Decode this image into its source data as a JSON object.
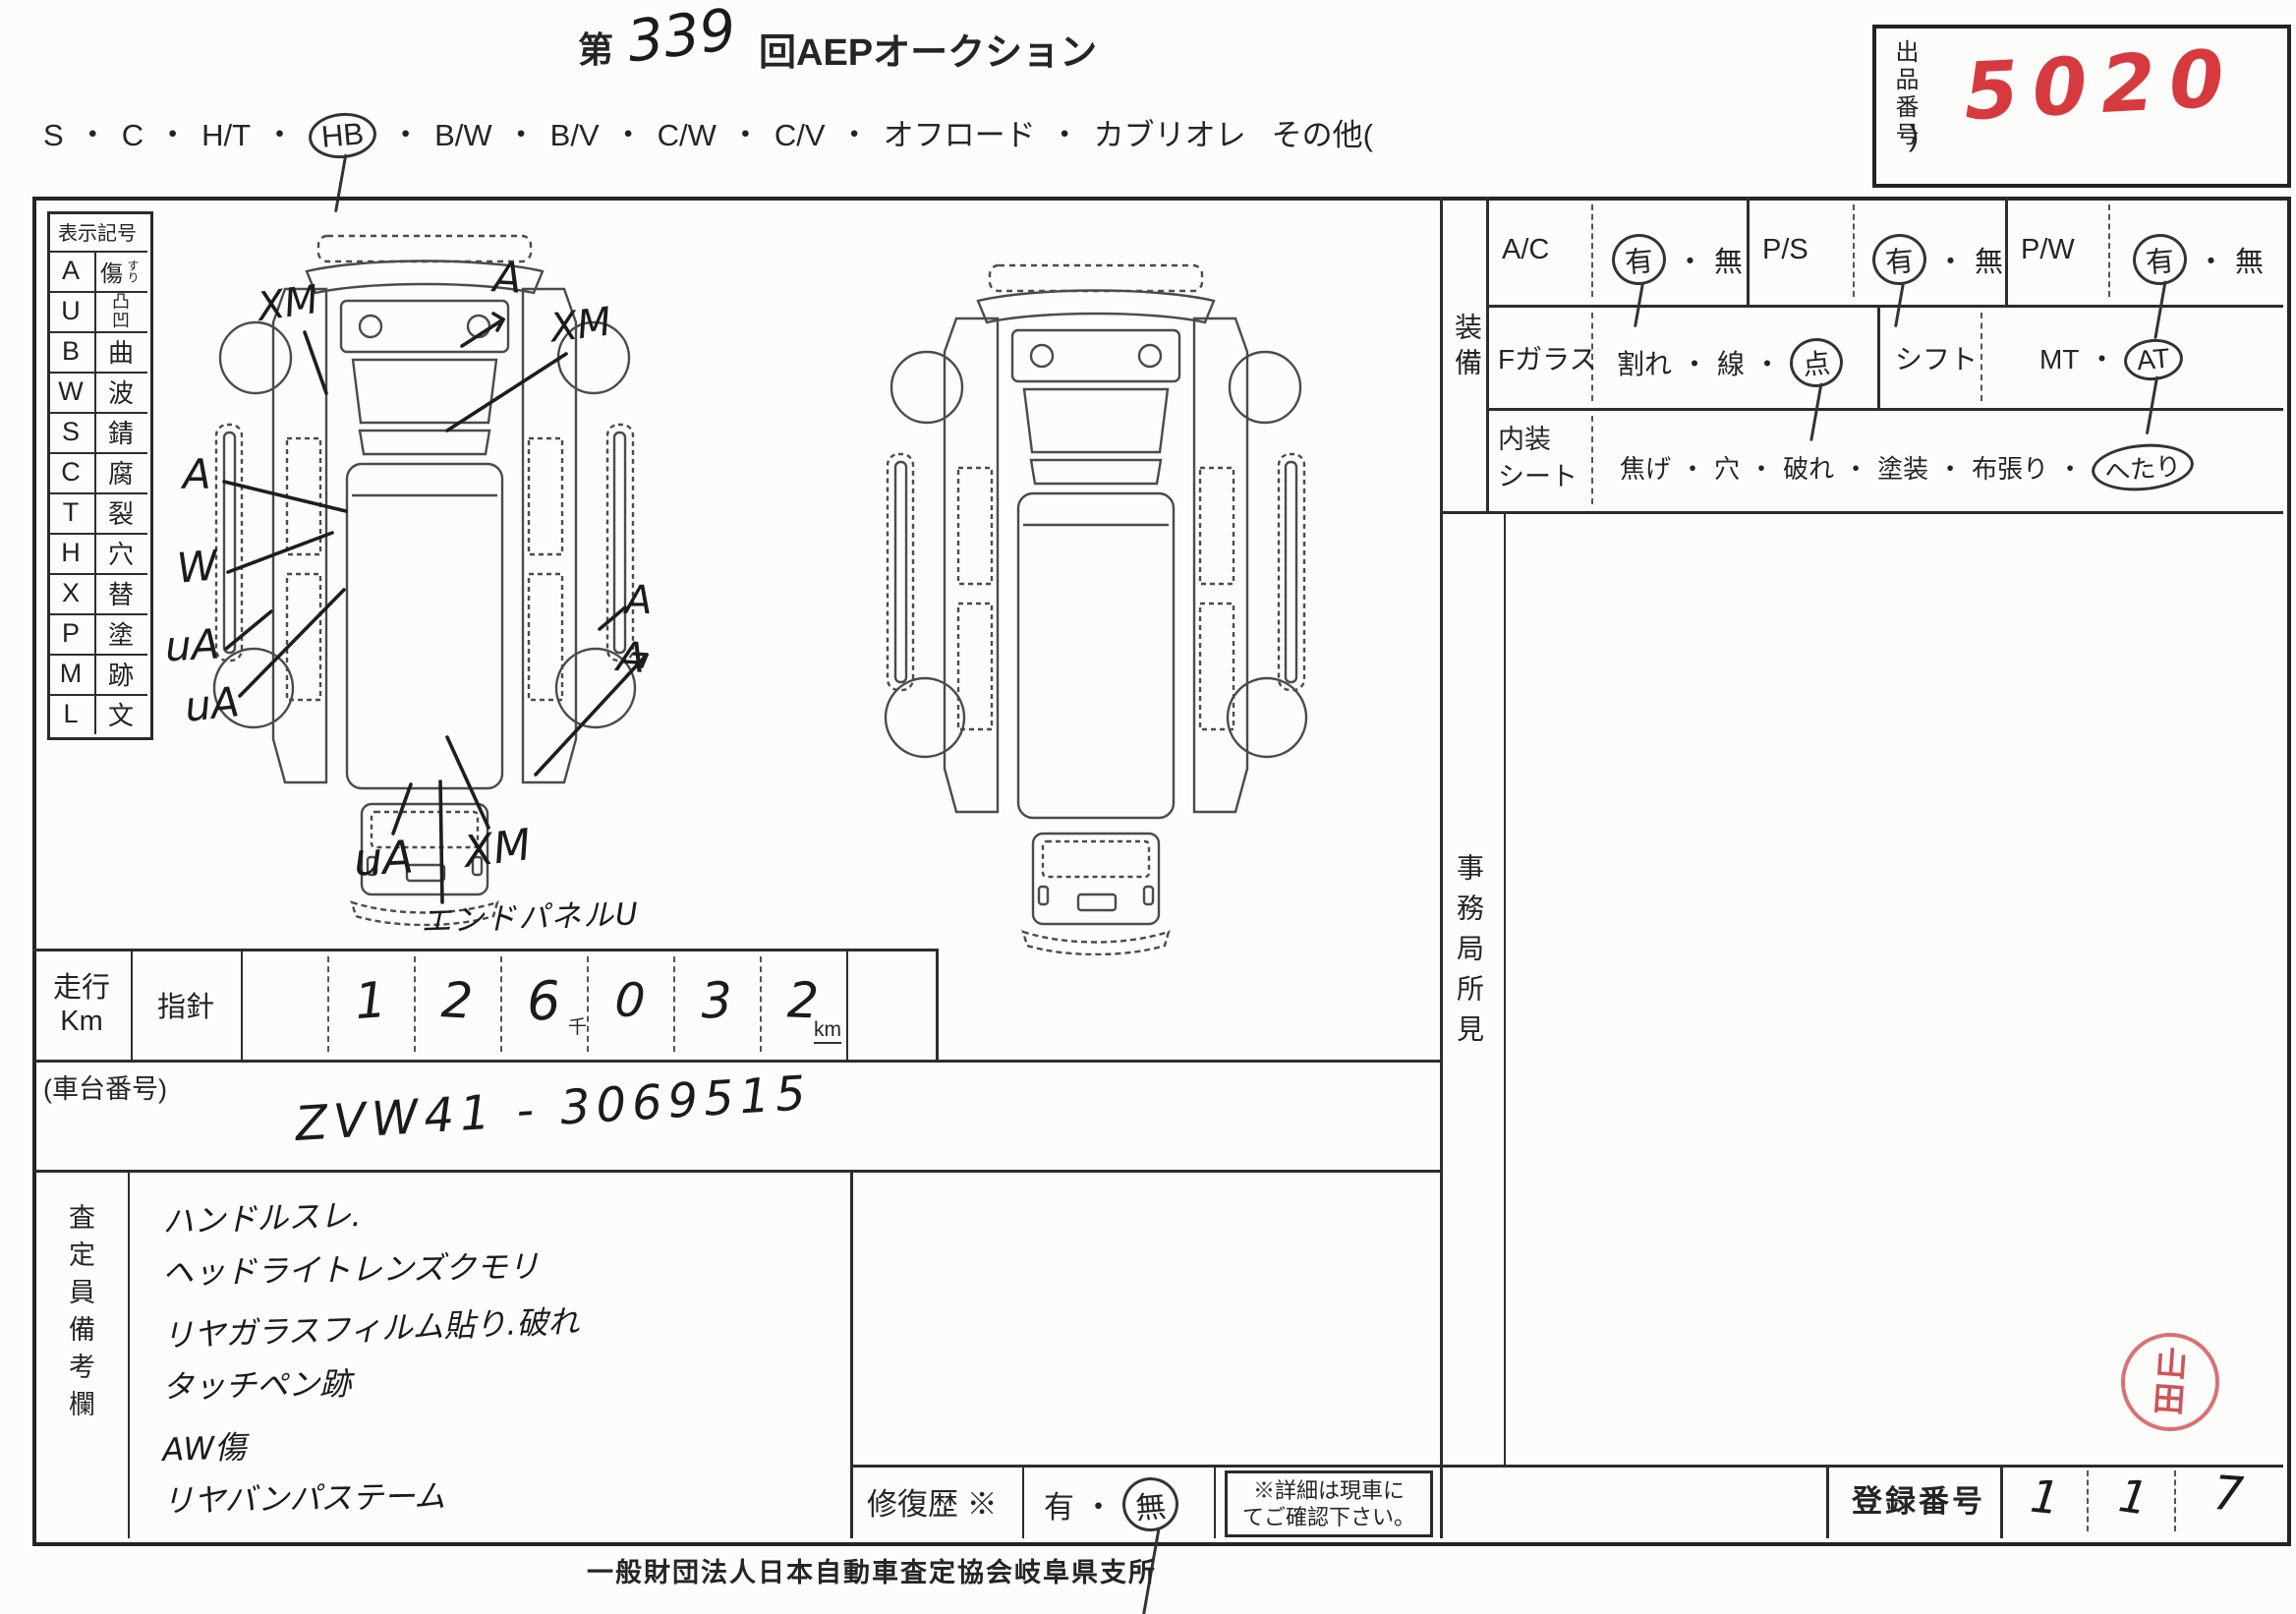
{
  "title": {
    "prefix": "第",
    "round": "339",
    "suffix": "回AEPオークション"
  },
  "exhibit": {
    "label": "出品番号",
    "value": "5020",
    "ink_color": "#d63a3f"
  },
  "body_types": {
    "options": [
      "S",
      "C",
      "H/T",
      "HB",
      "B/W",
      "B/V",
      "C/W",
      "C/V",
      "オフロード",
      "カブリオレ"
    ],
    "selected": "HB",
    "other_open": "その他(",
    "other_close": ")"
  },
  "symbol_table": {
    "header": "表示記号",
    "rows": [
      {
        "code": "A",
        "meaning": "傷",
        "ruby": "すり"
      },
      {
        "code": "U",
        "meaning": "凸凹",
        "ruby": ""
      },
      {
        "code": "B",
        "meaning": "曲",
        "ruby": ""
      },
      {
        "code": "W",
        "meaning": "波",
        "ruby": ""
      },
      {
        "code": "S",
        "meaning": "錆",
        "ruby": ""
      },
      {
        "code": "C",
        "meaning": "腐",
        "ruby": ""
      },
      {
        "code": "T",
        "meaning": "裂",
        "ruby": ""
      },
      {
        "code": "H",
        "meaning": "穴",
        "ruby": ""
      },
      {
        "code": "X",
        "meaning": "替",
        "ruby": ""
      },
      {
        "code": "P",
        "meaning": "塗",
        "ruby": ""
      },
      {
        "code": "M",
        "meaning": "跡",
        "ruby": ""
      },
      {
        "code": "L",
        "meaning": "文",
        "ruby": ""
      }
    ]
  },
  "diagram": {
    "annotations": [
      {
        "text": "XM"
      },
      {
        "text": "A"
      },
      {
        "text": "XM"
      },
      {
        "text": "A"
      },
      {
        "text": "W"
      },
      {
        "text": "uA"
      },
      {
        "text": "uA"
      },
      {
        "text": "A"
      },
      {
        "text": "A"
      },
      {
        "text": "uA"
      },
      {
        "text": "XM"
      }
    ],
    "caption": "エンドパネルU"
  },
  "mileage": {
    "label_top": "走行",
    "label_bottom": "Km",
    "gauge": "指針",
    "digits": [
      "",
      "1",
      "2",
      "6",
      "0",
      "3",
      "2"
    ],
    "thousand": "千",
    "unit": "km"
  },
  "chassis": {
    "label": "(車台番号)",
    "value": "ZVW41 - 3069515"
  },
  "remarks": {
    "label": "査定員備考欄",
    "lines": [
      "ハンドルスレ.",
      "ヘッドライトレンズクモリ",
      "リヤガラスフィルム貼り.破れ",
      "タッチペン跡",
      "AW傷",
      "リヤバンパステーム"
    ]
  },
  "equipment": {
    "section_label": "装備",
    "ac": {
      "label": "A/C",
      "opt1": "有",
      "opt2": "無",
      "selected": "有"
    },
    "ps": {
      "label": "P/S",
      "opt1": "有",
      "opt2": "無",
      "selected": "有"
    },
    "pw": {
      "label": "P/W",
      "opt1": "有",
      "opt2": "無",
      "selected": "有"
    },
    "glass": {
      "label": "Fガラス",
      "opt1": "割れ",
      "opt2": "線",
      "opt3": "点",
      "selected": "点"
    },
    "shift": {
      "label": "シフト",
      "opt1": "MT",
      "opt2": "AT",
      "selected": "AT"
    },
    "seat": {
      "label_line1": "内装",
      "label_line2": "シート",
      "opt1": "焦げ",
      "opt2": "穴",
      "opt3": "破れ",
      "opt4": "塗装",
      "opt5": "布張り",
      "opt6": "へたり",
      "selected": "へたり"
    }
  },
  "office": {
    "label": "事務局所見"
  },
  "repair": {
    "label": "修復歴 ※",
    "opt1": "有",
    "opt2": "無",
    "selected": "無",
    "note_line1": "※詳細は現車に",
    "note_line2": "てご確認下さい。"
  },
  "registration": {
    "label": "登録番号",
    "digits": [
      "1",
      "1",
      "7"
    ]
  },
  "stamp": {
    "line1": "山",
    "line2": "田"
  },
  "footer": {
    "text": "一般財団法人日本自動車査定協会岐阜県支所"
  }
}
